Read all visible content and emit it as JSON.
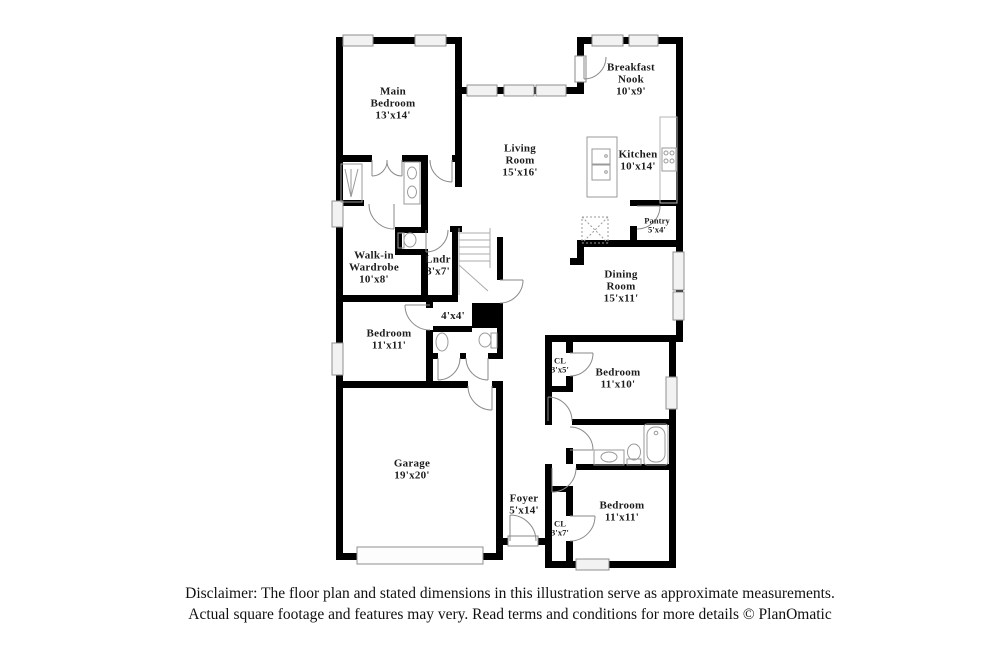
{
  "rooms": [
    {
      "name": "Main\nBedroom",
      "dims": "13'x14'"
    },
    {
      "name": "Breakfast\nNook",
      "dims": "10'x9'"
    },
    {
      "name": "Living\nRoom",
      "dims": "15'x16'"
    },
    {
      "name": "Kitchen",
      "dims": "10'x14'"
    },
    {
      "name": "Pantry",
      "dims": "5'x4'"
    },
    {
      "name": "Dining\nRoom",
      "dims": "15'x11'"
    },
    {
      "name": "Walk-in\nWardrobe",
      "dims": "10'x8'"
    },
    {
      "name": "Lndr",
      "dims": "3'x7'"
    },
    {
      "name": "",
      "dims": "4'x4'"
    },
    {
      "name": "Bedroom",
      "dims": "11'x11'"
    },
    {
      "name": "CL",
      "dims": "3'x5'"
    },
    {
      "name": "Bedroom",
      "dims": "11'x10'"
    },
    {
      "name": "Garage",
      "dims": "19'x20'"
    },
    {
      "name": "Foyer",
      "dims": "5'x14'"
    },
    {
      "name": "CL",
      "dims": "3'x7'"
    },
    {
      "name": "Bedroom",
      "dims": "11'x11'"
    }
  ],
  "disclaimer": {
    "line1": "Disclaimer: The floor plan and stated dimensions in this illustration serve as approximate measurements.",
    "line2": "Actual square footage and features may very. Read terms and conditions for more details © PlanOmatic"
  },
  "colors": {
    "wall": "#000000",
    "background": "#ffffff",
    "fixture_stroke": "#999999",
    "window_fill": "#f2f2f2",
    "label_text": "#1c1c1c"
  }
}
